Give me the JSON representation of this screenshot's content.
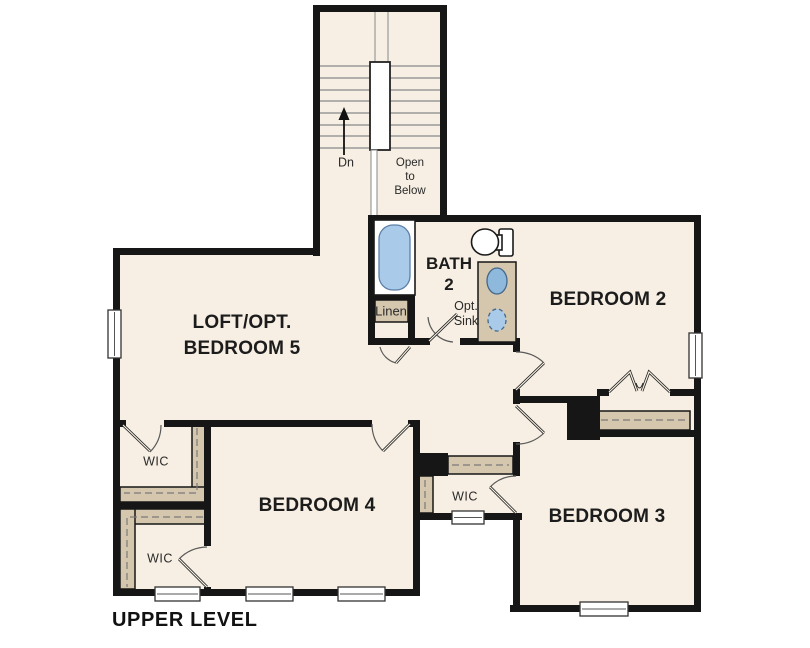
{
  "title": {
    "text": "UPPER LEVEL"
  },
  "rooms": {
    "loft": {
      "line1": "LOFT/OPT.",
      "line2": "BEDROOM 5"
    },
    "bedroom2": {
      "label": "BEDROOM 2"
    },
    "bedroom3": {
      "label": "BEDROOM 3"
    },
    "bedroom4": {
      "label": "BEDROOM 4"
    },
    "bath2": {
      "line1": "BATH",
      "line2": "2"
    },
    "wic": {
      "label": "WIC"
    },
    "linen": {
      "label": "Linen"
    }
  },
  "stairs": {
    "down_label": "Dn",
    "open_to_below": {
      "line1": "Open",
      "line2": "to",
      "line3": "Below"
    }
  },
  "fixtures": {
    "opt_sink": {
      "line1": "Opt.",
      "line2": "Sink"
    }
  },
  "colors": {
    "background": "#ffffff",
    "floor": "#f7efe3",
    "wall": "#161616",
    "shelf_tan": "#d5c7ae",
    "tub_blue": "#a9cae8",
    "sink_blue": "#8fb9dc"
  }
}
